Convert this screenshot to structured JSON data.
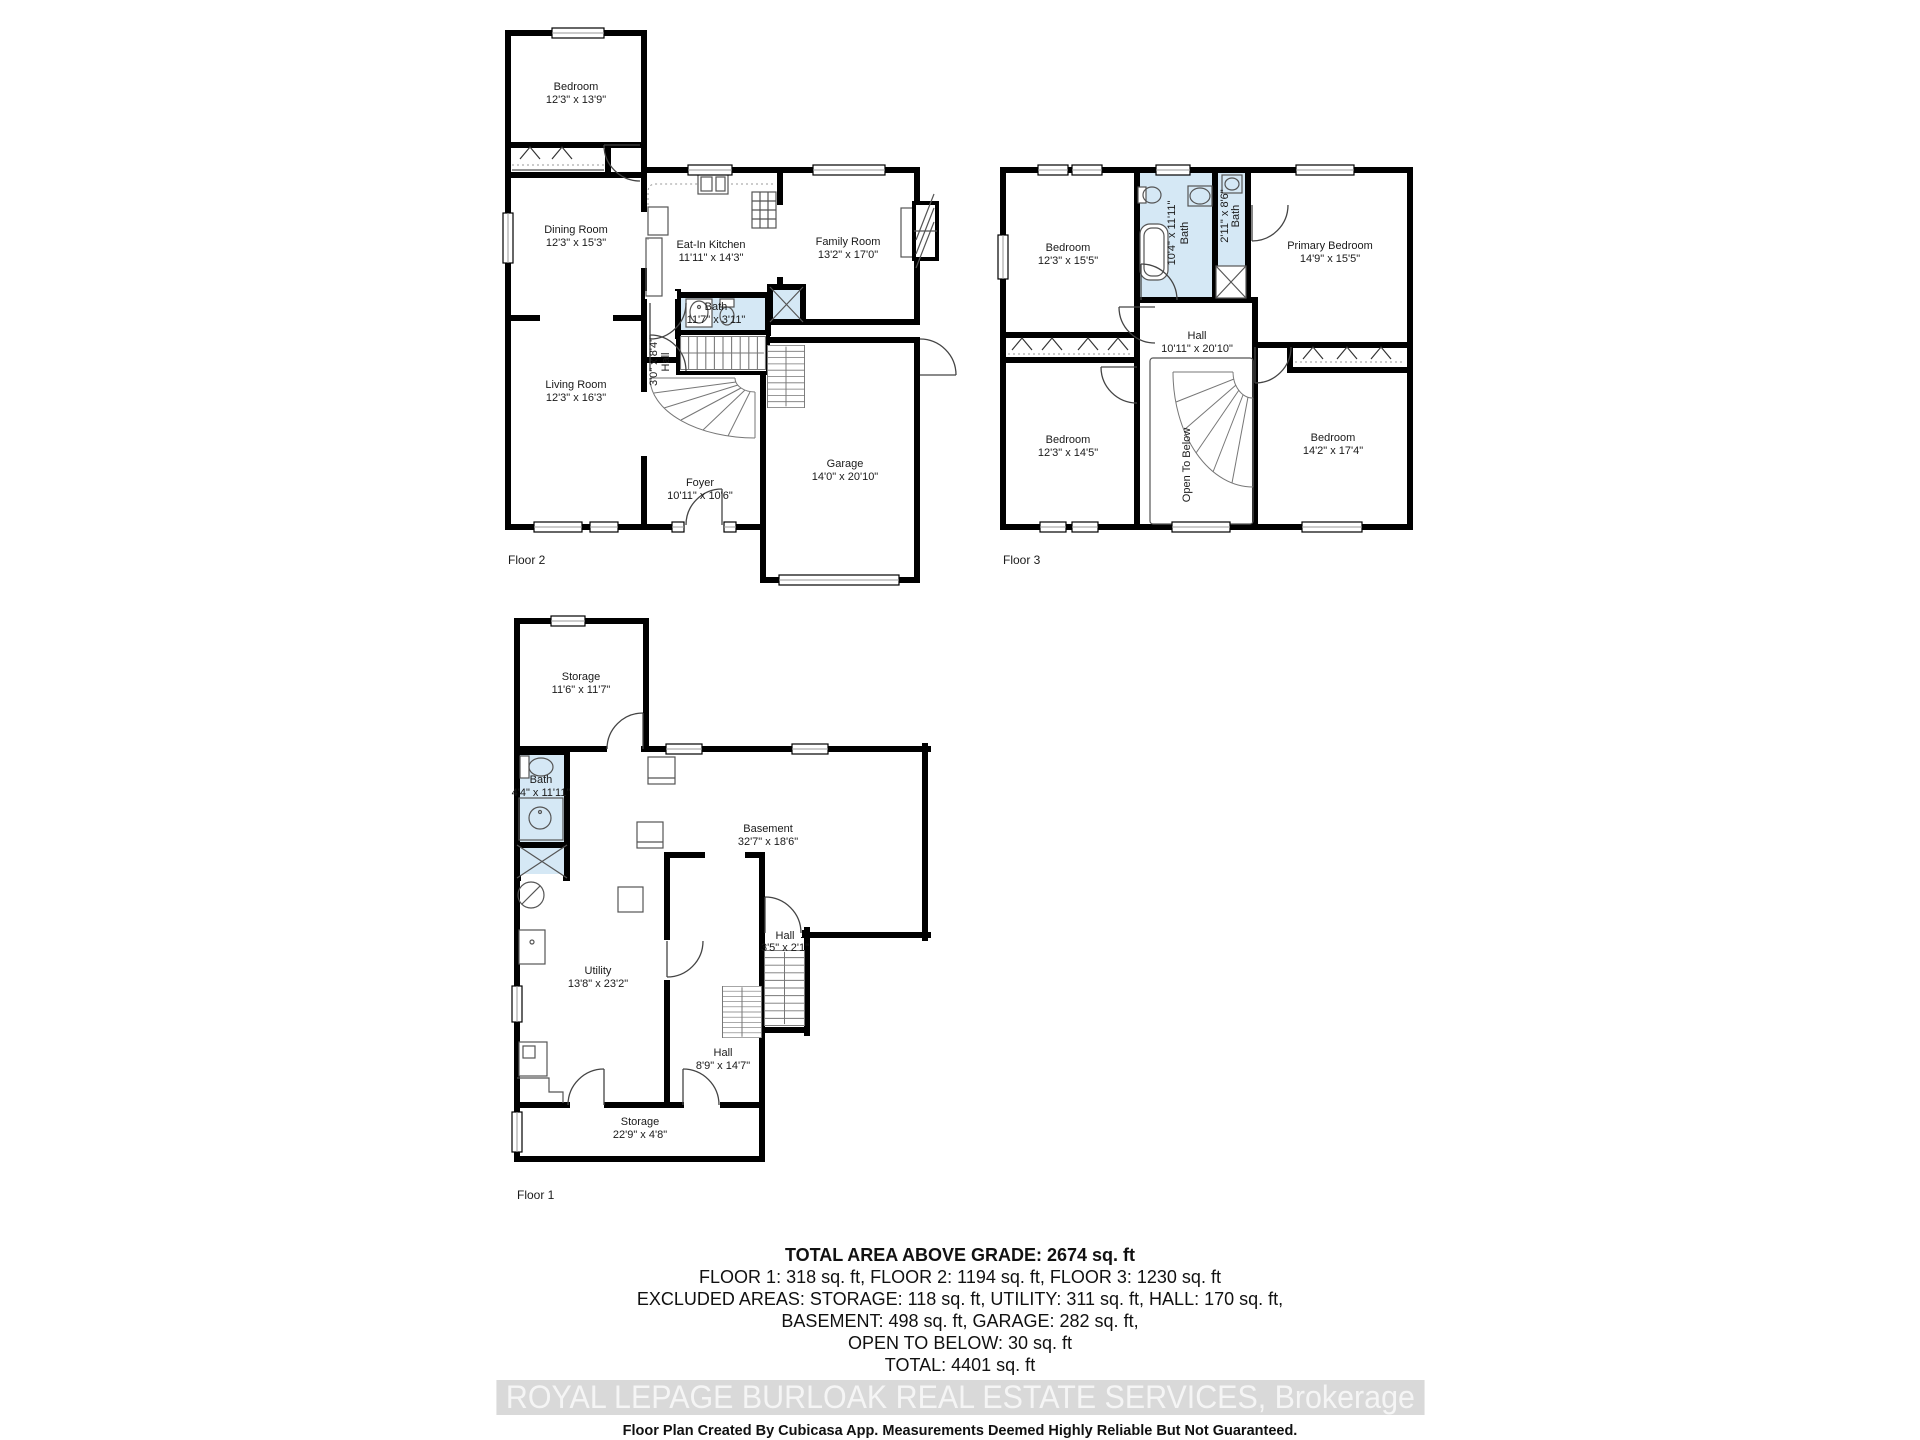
{
  "floors": [
    {
      "caption": "Floor 2",
      "rooms": [
        {
          "name": "Bedroom",
          "dims": "12'3\" x 13'9\""
        },
        {
          "name": "Dining Room",
          "dims": "12'3\" x 15'3\""
        },
        {
          "name": "Eat-In Kitchen",
          "dims": "11'11\" x 14'3\""
        },
        {
          "name": "Family Room",
          "dims": "13'2\" x 17'0\""
        },
        {
          "name": "Bath",
          "dims": "11'7\" x 3'11\""
        },
        {
          "name": "Hall",
          "dims": "3'0\" x 8'4\""
        },
        {
          "name": "Living Room",
          "dims": "12'3\" x 16'3\""
        },
        {
          "name": "Foyer",
          "dims": "10'11\" x 10'6\""
        },
        {
          "name": "Garage",
          "dims": "14'0\" x 20'10\""
        }
      ]
    },
    {
      "caption": "Floor 3",
      "rooms": [
        {
          "name": "Bedroom",
          "dims": "12'3\" x 15'5\""
        },
        {
          "name": "Bath",
          "dims": "10'4\" x 11'11\""
        },
        {
          "name": "Bath",
          "dims": "2'11\" x 8'6\""
        },
        {
          "name": "Primary Bedroom",
          "dims": "14'9\" x 15'5\""
        },
        {
          "name": "Hall",
          "dims": "10'11\" x 20'10\""
        },
        {
          "name": "Open To Below",
          "dims": ""
        },
        {
          "name": "Bedroom",
          "dims": "12'3\" x 14'5\""
        },
        {
          "name": "Bedroom",
          "dims": "14'2\" x 17'4\""
        }
      ]
    },
    {
      "caption": "Floor 1",
      "rooms": [
        {
          "name": "Storage",
          "dims": "11'6\" x 11'7\""
        },
        {
          "name": "Bath",
          "dims": "4'4\" x 11'11\""
        },
        {
          "name": "Basement",
          "dims": "32'7\" x 18'6\""
        },
        {
          "name": "Utility",
          "dims": "13'8\" x 23'2\""
        },
        {
          "name": "Hall",
          "dims": "3'5\" x 2'1\""
        },
        {
          "name": "Hall",
          "dims": "8'9\" x 14'7\""
        },
        {
          "name": "Storage",
          "dims": "22'9\" x 4'8\""
        }
      ]
    }
  ],
  "summary": {
    "title": "TOTAL AREA ABOVE GRADE: 2674 sq. ft",
    "line_floors": "FLOOR 1: 318 sq. ft, FLOOR 2: 1194 sq. ft, FLOOR 3: 1230 sq. ft",
    "line_excluded_1": "EXCLUDED AREAS: STORAGE: 118 sq. ft, UTILITY: 311 sq. ft, HALL: 170 sq. ft,",
    "line_excluded_2": "BASEMENT: 498 sq. ft, GARAGE: 282 sq. ft,",
    "line_open_below": "OPEN TO BELOW: 30 sq. ft",
    "line_total": "TOTAL: 4401 sq. ft"
  },
  "watermark": {
    "text": "ROYAL LEPAGE BURLOAK REAL ESTATE SERVICES, Brokerage"
  },
  "disclaimer": {
    "text": "Floor Plan Created By Cubicasa App. Measurements Deemed Highly Reliable But Not Guaranteed."
  },
  "colors": {
    "wall": "#000000",
    "bath_fill": "#d5e8f5",
    "watermark_band": "#d9d9d9",
    "watermark_text": "#f5f5f5"
  }
}
